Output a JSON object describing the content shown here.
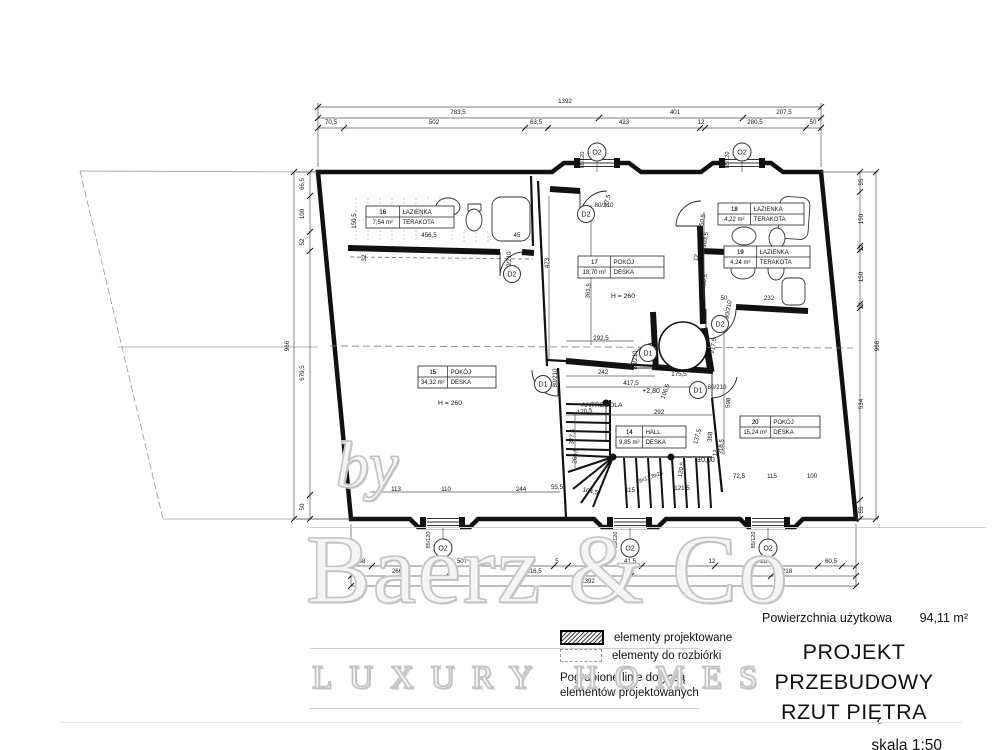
{
  "title_block": {
    "area_label": "Powierzchnia użytkowa",
    "area_value": "94,11 m²",
    "line1": "PROJEKT PRZEBUDOWY",
    "line2": "RZUT PIĘTRA",
    "scale": "skala 1:50"
  },
  "legend": {
    "item_new": "elementy projektowane",
    "item_demolish": "elementy do rozbiórki",
    "note1": "Pogrubione linie dotyczą",
    "note2": "elementów projektowanych"
  },
  "watermark": {
    "by": "by",
    "brand": "Baerz & Co",
    "tagline": "LUXURY HOMES"
  },
  "rooms": [
    {
      "num": "16",
      "name": "ŁAZIENKA",
      "area": "7,54 m²",
      "floor": "TERAKOTA",
      "x": 366,
      "y": 206,
      "w": 88
    },
    {
      "num": "17",
      "name": "POKÓJ",
      "area": "18,70 m²",
      "floor": "DESKA",
      "x": 578,
      "y": 256,
      "w": 86
    },
    {
      "num": "18",
      "name": "ŁAZIENKA",
      "area": "4,22 m²",
      "floor": "TERAKOTA",
      "x": 718,
      "y": 203,
      "w": 86
    },
    {
      "num": "19",
      "name": "ŁAZIENKA",
      "area": "4,24 m²",
      "floor": "TERAKOTA",
      "x": 724,
      "y": 246,
      "w": 86
    },
    {
      "num": "15",
      "name": "POKÓJ",
      "area": "34,32 m²",
      "floor": "DESKA",
      "x": 418,
      "y": 366,
      "w": 78
    },
    {
      "num": "20",
      "name": "POKÓJ",
      "area": "15,24 m²",
      "floor": "DESKA",
      "x": 740,
      "y": 416,
      "w": 80
    },
    {
      "num": "14",
      "name": "HALL",
      "area": "9,85 m²",
      "floor": "DESKA",
      "x": 616,
      "y": 426,
      "w": 70
    }
  ],
  "window_markers": [
    {
      "label": "O2",
      "x": 597,
      "y": 152
    },
    {
      "label": "O2",
      "x": 742,
      "y": 152
    },
    {
      "label": "O2",
      "x": 443,
      "y": 548
    },
    {
      "label": "O2",
      "x": 630,
      "y": 548
    },
    {
      "label": "O2",
      "x": 768,
      "y": 548
    }
  ],
  "door_markers": [
    {
      "label": "D2",
      "x": 512,
      "y": 274
    },
    {
      "label": "D2",
      "x": 586,
      "y": 214
    },
    {
      "label": "D2",
      "x": 720,
      "y": 324
    },
    {
      "label": "D1",
      "x": 543,
      "y": 384
    },
    {
      "label": "D1",
      "x": 648,
      "y": 353
    },
    {
      "label": "D1",
      "x": 698,
      "y": 390
    }
  ],
  "annotations": [
    {
      "t": "1392",
      "x": 565,
      "y": 103
    },
    {
      "t": "783,5",
      "x": 458,
      "y": 114
    },
    {
      "t": "401",
      "x": 675,
      "y": 114
    },
    {
      "t": "207,5",
      "x": 784,
      "y": 114
    },
    {
      "t": "70,5",
      "x": 331,
      "y": 124
    },
    {
      "t": "502",
      "x": 434,
      "y": 124
    },
    {
      "t": "63,5",
      "x": 536,
      "y": 124
    },
    {
      "t": "423",
      "x": 624,
      "y": 124
    },
    {
      "t": "12",
      "x": 701,
      "y": 124
    },
    {
      "t": "280,5",
      "x": 755,
      "y": 124
    },
    {
      "t": "50",
      "x": 813,
      "y": 124
    },
    {
      "t": "66,5",
      "x": 304,
      "y": 184,
      "r": -90
    },
    {
      "t": "100",
      "x": 304,
      "y": 214,
      "r": -90
    },
    {
      "t": "52",
      "x": 304,
      "y": 242,
      "r": -90
    },
    {
      "t": "679,5",
      "x": 304,
      "y": 373,
      "r": -90
    },
    {
      "t": "50",
      "x": 304,
      "y": 507,
      "r": -90
    },
    {
      "t": "966",
      "x": 289,
      "y": 346,
      "r": -90
    },
    {
      "t": "55",
      "x": 863,
      "y": 182,
      "r": -90
    },
    {
      "t": "150",
      "x": 863,
      "y": 219,
      "r": -90
    },
    {
      "t": "12",
      "x": 863,
      "y": 248,
      "r": -90
    },
    {
      "t": "150",
      "x": 863,
      "y": 277,
      "r": -90
    },
    {
      "t": "12",
      "x": 863,
      "y": 306,
      "r": -90
    },
    {
      "t": "534",
      "x": 863,
      "y": 404,
      "r": -90
    },
    {
      "t": "55",
      "x": 863,
      "y": 510,
      "r": -90
    },
    {
      "t": "966",
      "x": 879,
      "y": 346,
      "r": -90
    },
    {
      "t": "58",
      "x": 362,
      "y": 563
    },
    {
      "t": "507",
      "x": 462,
      "y": 563
    },
    {
      "t": "5",
      "x": 557,
      "y": 563
    },
    {
      "t": "41,5",
      "x": 630,
      "y": 563
    },
    {
      "t": "12",
      "x": 712,
      "y": 563
    },
    {
      "t": "287,5",
      "x": 768,
      "y": 563
    },
    {
      "t": "60,5",
      "x": 831,
      "y": 563
    },
    {
      "t": "266",
      "x": 397,
      "y": 573
    },
    {
      "t": "516,5",
      "x": 534,
      "y": 573
    },
    {
      "t": "391",
      "x": 683,
      "y": 573
    },
    {
      "t": "218",
      "x": 787,
      "y": 573
    },
    {
      "t": "1392",
      "x": 588,
      "y": 583
    },
    {
      "t": "150,5",
      "x": 356,
      "y": 221,
      "r": -90
    },
    {
      "t": "32",
      "x": 366,
      "y": 258,
      "r": -90
    },
    {
      "t": "456,5",
      "x": 429,
      "y": 237
    },
    {
      "t": "45",
      "x": 517,
      "y": 237
    },
    {
      "t": "80/210",
      "x": 511,
      "y": 261,
      "r": -90
    },
    {
      "t": "473",
      "x": 549,
      "y": 263,
      "r": -90
    },
    {
      "t": "47,5",
      "x": 609,
      "y": 201,
      "r": -75
    },
    {
      "t": "80/210",
      "x": 604,
      "y": 207
    },
    {
      "t": "361,5",
      "x": 590,
      "y": 291,
      "r": -85
    },
    {
      "t": "150,5",
      "x": 704,
      "y": 222,
      "r": -80
    },
    {
      "t": "103,5",
      "x": 707,
      "y": 240,
      "r": -80
    },
    {
      "t": "12",
      "x": 698,
      "y": 258,
      "r": -80
    },
    {
      "t": "282",
      "x": 748,
      "y": 262
    },
    {
      "t": "150,5",
      "x": 706,
      "y": 282,
      "r": -80
    },
    {
      "t": "50",
      "x": 724,
      "y": 300
    },
    {
      "t": "232",
      "x": 769,
      "y": 300
    },
    {
      "t": "90/210",
      "x": 730,
      "y": 310,
      "r": -80
    },
    {
      "t": "217,5",
      "x": 715,
      "y": 346,
      "r": -80
    },
    {
      "t": "292,5",
      "x": 601,
      "y": 340
    },
    {
      "t": "80/210",
      "x": 637,
      "y": 360,
      "r": -90
    },
    {
      "t": "242",
      "x": 603,
      "y": 374
    },
    {
      "t": "175,5",
      "x": 679,
      "y": 376
    },
    {
      "t": "417,5",
      "x": 631,
      "y": 385
    },
    {
      "t": "106,5",
      "x": 667,
      "y": 392,
      "r": -70
    },
    {
      "t": "+2,80",
      "x": 651,
      "y": 393,
      "s": 7
    },
    {
      "t": "80/210",
      "x": 557,
      "y": 378,
      "r": -90
    },
    {
      "t": "ANTRESOLA",
      "x": 602,
      "y": 407,
      "s": 6.8
    },
    {
      "t": "292",
      "x": 659,
      "y": 414
    },
    {
      "t": "120,5",
      "x": 585,
      "y": 413,
      "r": -8
    },
    {
      "t": "80/210",
      "x": 717,
      "y": 389
    },
    {
      "t": "598",
      "x": 730,
      "y": 403,
      "r": -85
    },
    {
      "t": "368",
      "x": 712,
      "y": 437,
      "r": -85
    },
    {
      "t": "318,5",
      "x": 723,
      "y": 447,
      "r": -85
    },
    {
      "t": "137,5",
      "x": 699,
      "y": 437,
      "r": -75
    },
    {
      "t": "±0,00",
      "x": 706,
      "y": 462,
      "s": 7
    },
    {
      "t": "377,5",
      "x": 574,
      "y": 437,
      "r": -85
    },
    {
      "t": "264,5",
      "x": 577,
      "y": 456,
      "r": -85
    },
    {
      "t": "120,5",
      "x": 683,
      "y": 470,
      "r": -80
    },
    {
      "t": "12",
      "x": 717,
      "y": 453,
      "r": -85
    },
    {
      "t": "19x17,8x25",
      "x": 650,
      "y": 479,
      "r": -20,
      "s": 5.5
    },
    {
      "t": "55,5",
      "x": 557,
      "y": 489
    },
    {
      "t": "104,5",
      "x": 590,
      "y": 493,
      "r": 12
    },
    {
      "t": "115",
      "x": 630,
      "y": 492
    },
    {
      "t": "121,5",
      "x": 682,
      "y": 490
    },
    {
      "t": "72,5",
      "x": 739,
      "y": 478
    },
    {
      "t": "115",
      "x": 772,
      "y": 478
    },
    {
      "t": "100",
      "x": 812,
      "y": 478
    },
    {
      "t": "113",
      "x": 396,
      "y": 491
    },
    {
      "t": "110",
      "x": 446,
      "y": 491
    },
    {
      "t": "244",
      "x": 521,
      "y": 491
    },
    {
      "t": "H = 260",
      "x": 450,
      "y": 405,
      "s": 6.8
    },
    {
      "t": "H = 260",
      "x": 623,
      "y": 298,
      "s": 6.8
    },
    {
      "t": "85/120",
      "x": 584,
      "y": 160,
      "r": -90,
      "s": 5.5
    },
    {
      "t": "85/120",
      "x": 729,
      "y": 160,
      "r": -90,
      "s": 5.5
    },
    {
      "t": "85/120",
      "x": 430,
      "y": 540,
      "r": -90,
      "s": 5.5
    },
    {
      "t": "85/120",
      "x": 617,
      "y": 540,
      "r": -90,
      "s": 5.5
    },
    {
      "t": "85/120",
      "x": 755,
      "y": 540,
      "r": -90,
      "s": 5.5
    }
  ]
}
